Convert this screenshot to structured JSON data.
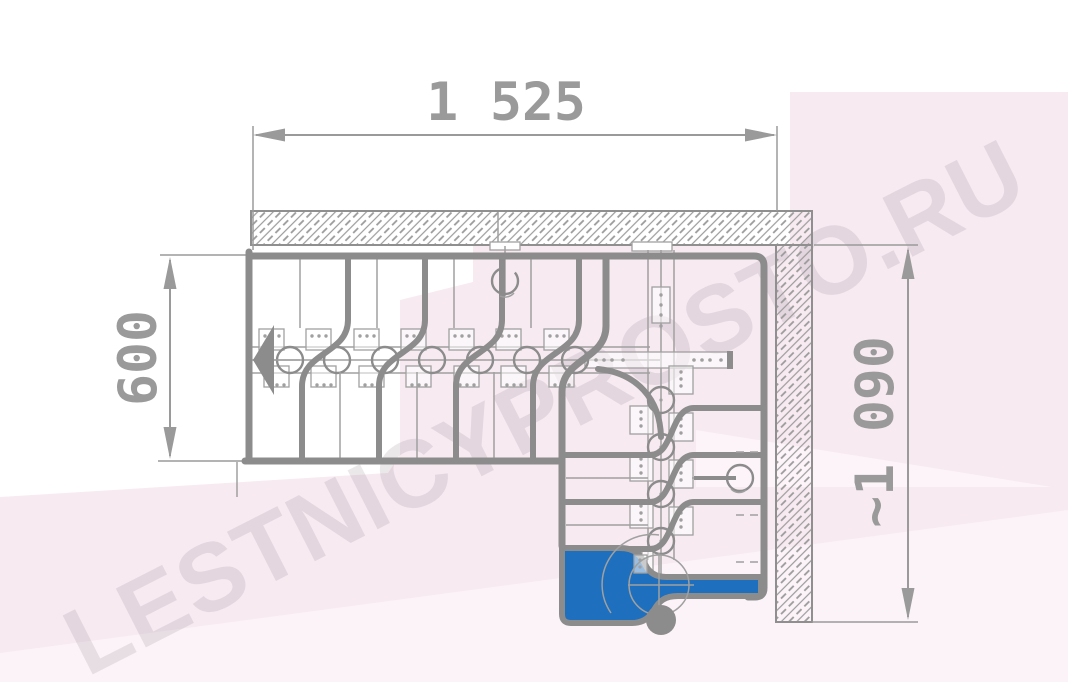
{
  "dimensions": {
    "top": "1 525",
    "left": "600",
    "right": "~1 090"
  },
  "watermark": {
    "text": "LESTNICYPROSTO.RU"
  },
  "icons": {
    "direction_arrow": "filled-left-triangle",
    "support_post": "filled-circle",
    "dimension_arrows": "filled-slim-triangles"
  },
  "colors": {
    "paper_white": "#ffffff",
    "bg_pink": "#f7eaf1",
    "bg_pink_light": "#fcf5f9",
    "line_gray": "#8c8c8c",
    "thin_gray": "#a0a0a0",
    "dim_gray": "#9a9a9a",
    "wall_edge": "#8f8f8f",
    "accent_blue": "#1e6fbe"
  }
}
